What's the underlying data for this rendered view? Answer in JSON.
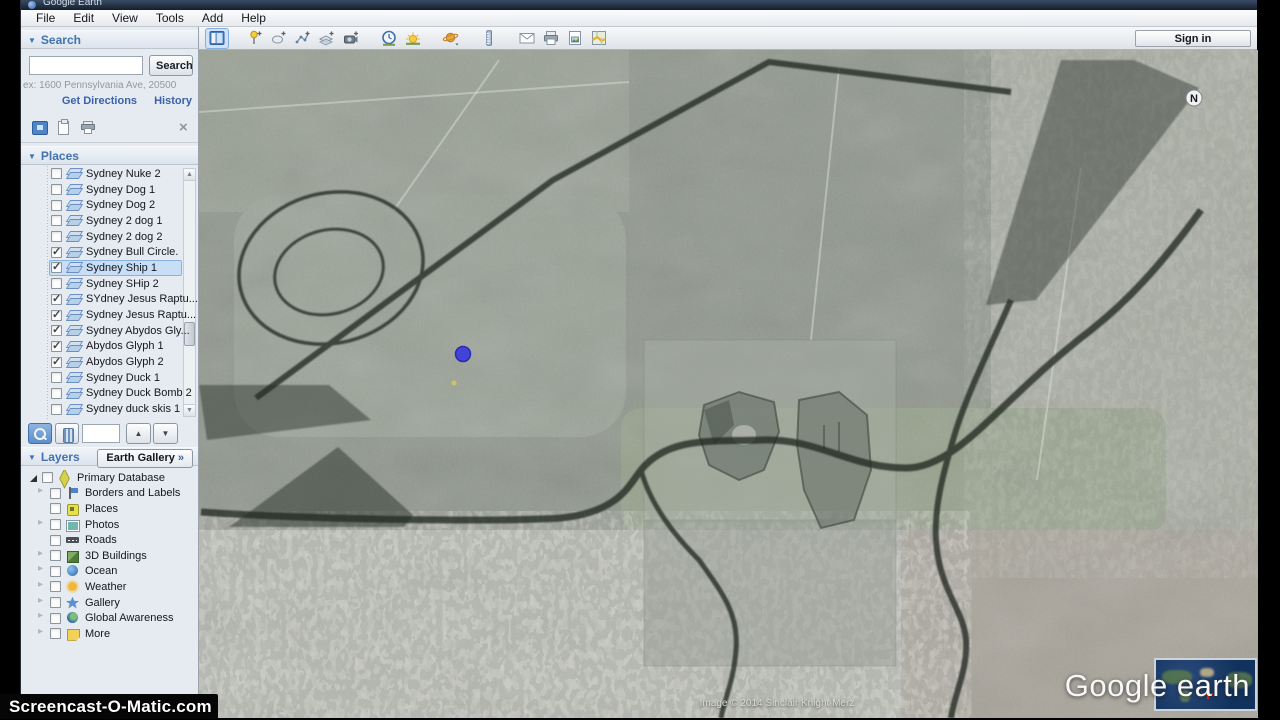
{
  "window": {
    "title": "Google Earth"
  },
  "menu": {
    "items": [
      {
        "label": "File"
      },
      {
        "label": "Edit"
      },
      {
        "label": "View"
      },
      {
        "label": "Tools"
      },
      {
        "label": "Add"
      },
      {
        "label": "Help"
      }
    ]
  },
  "search": {
    "header": "Search",
    "button": "Search",
    "input_value": "",
    "hint": "ex: 1600 Pennsylvania Ave, 20500",
    "directions_link": "Get Directions",
    "history_link": "History"
  },
  "places": {
    "header": "Places",
    "items": [
      {
        "label": "Sydney Nuke 2",
        "checked": false,
        "selected": false
      },
      {
        "label": "Sydney Dog 1",
        "checked": false,
        "selected": false
      },
      {
        "label": "Sydney Dog 2",
        "checked": false,
        "selected": false
      },
      {
        "label": "Sydney 2 dog 1",
        "checked": false,
        "selected": false
      },
      {
        "label": "Sydney 2 dog 2",
        "checked": false,
        "selected": false
      },
      {
        "label": "Sydney Bull Circle.",
        "checked": true,
        "selected": false
      },
      {
        "label": "Sydney Ship 1",
        "checked": true,
        "selected": true
      },
      {
        "label": "Sydney SHip 2",
        "checked": false,
        "selected": false
      },
      {
        "label": "SYdney Jesus Raptu...",
        "checked": true,
        "selected": false
      },
      {
        "label": "Sydney Jesus Raptu...",
        "checked": true,
        "selected": false
      },
      {
        "label": "Sydney Abydos Gly...",
        "checked": true,
        "selected": false
      },
      {
        "label": "Abydos Glyph 1",
        "checked": true,
        "selected": false
      },
      {
        "label": "Abydos Glyph 2",
        "checked": true,
        "selected": false
      },
      {
        "label": "Sydney Duck 1",
        "checked": false,
        "selected": false
      },
      {
        "label": "Sydney Duck Bomb 2",
        "checked": false,
        "selected": false
      },
      {
        "label": "Sydney duck skis 1",
        "checked": false,
        "selected": false
      }
    ]
  },
  "layers": {
    "header": "Layers",
    "gallery_button": "Earth Gallery",
    "gallery_chevron": "»",
    "items": [
      {
        "label": "Primary Database",
        "icon": "primary-db",
        "expander": "open",
        "child": false,
        "checked": false
      },
      {
        "label": "Borders and Labels",
        "icon": "borders",
        "expander": "closed",
        "child": true,
        "checked": false
      },
      {
        "label": "Places",
        "icon": "places-l",
        "expander": "none",
        "child": true,
        "checked": false
      },
      {
        "label": "Photos",
        "icon": "photos",
        "expander": "closed",
        "child": true,
        "checked": false
      },
      {
        "label": "Roads",
        "icon": "roads",
        "expander": "none",
        "child": true,
        "checked": false
      },
      {
        "label": "3D Buildings",
        "icon": "buildings",
        "expander": "closed",
        "child": true,
        "checked": false
      },
      {
        "label": "Ocean",
        "icon": "ocean",
        "expander": "closed",
        "child": true,
        "checked": false
      },
      {
        "label": "Weather",
        "icon": "weather",
        "expander": "closed",
        "child": true,
        "checked": false
      },
      {
        "label": "Gallery",
        "icon": "gallery",
        "expander": "closed",
        "child": true,
        "checked": false
      },
      {
        "label": "Global Awareness",
        "icon": "global",
        "expander": "closed",
        "child": true,
        "checked": false
      },
      {
        "label": "More",
        "icon": "more",
        "expander": "closed",
        "child": true,
        "checked": false
      }
    ]
  },
  "toolbar": {
    "signin_button": "Sign in",
    "icons": [
      "sidebar-toggle",
      "placemark",
      "polygon",
      "path",
      "image-overlay",
      "record-tour",
      "historical-imagery",
      "sunlight",
      "planets",
      "ruler",
      "email",
      "print",
      "save-image",
      "view-in-maps"
    ]
  },
  "map": {
    "attribution": "Image © 2014 Sinclair Knight Merz",
    "logo": "Google earth",
    "compass_label": "N"
  },
  "watermark": "Screencast-O-Matic.com",
  "colors": {
    "accent": "#4272b0",
    "selection": "#c7def6",
    "marker_blue": "#4343d6"
  }
}
